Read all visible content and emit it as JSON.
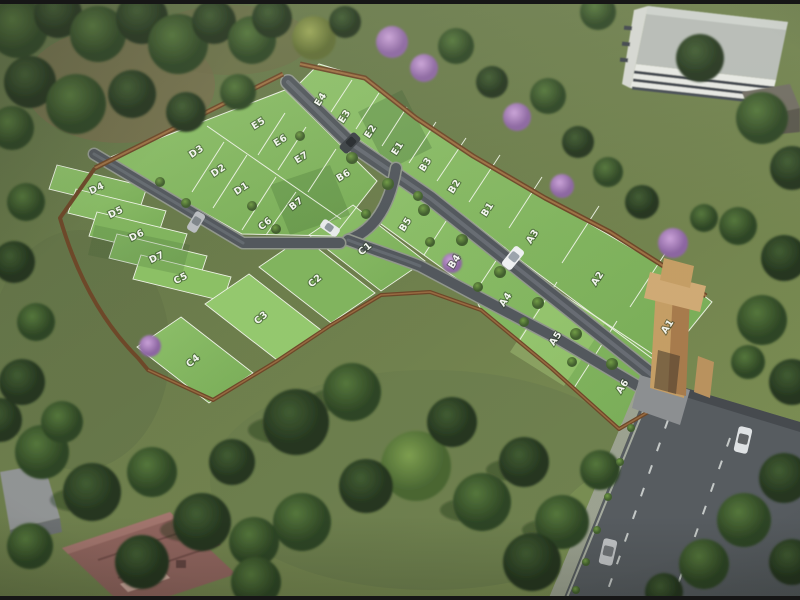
{
  "scene": {
    "title": "Aerial 3D render of a residential plotted layout",
    "setting": "Landscaped green site with white-lined grass plots, internal grey roads, brown boundary wall, sandstone entrance gate, surrounding trees and an adjacent public road"
  },
  "plots": {
    "count": 33,
    "series_names": [
      "A",
      "B",
      "C",
      "D",
      "E"
    ],
    "all": [
      "A1",
      "A2",
      "A3",
      "A4",
      "A5",
      "A6",
      "B1",
      "B2",
      "B3",
      "B4",
      "B5",
      "B6",
      "B7",
      "C1",
      "C2",
      "C3",
      "C4",
      "C5",
      "C6",
      "D1",
      "D2",
      "D3",
      "D4",
      "D5",
      "D6",
      "D7",
      "E1",
      "E2",
      "E3",
      "E4",
      "E5",
      "E6",
      "E7"
    ]
  },
  "objects": {
    "cars": [
      {
        "color": "dark grey SUV",
        "location": "top internal road"
      },
      {
        "color": "white sedan",
        "location": "central junction"
      },
      {
        "color": "white SUV",
        "location": "main internal road"
      },
      {
        "color": "silver SUV",
        "location": "west internal road"
      },
      {
        "color": "white SUV",
        "location": "public road (upper)"
      },
      {
        "color": "silver hatchback",
        "location": "public road (lower)"
      }
    ],
    "buildings": [
      {
        "type": "white multi-storey block with window bands",
        "location": "top right"
      },
      {
        "type": "grey-roof house",
        "location": "top right corner"
      },
      {
        "type": "brick-red apartment roof",
        "location": "bottom left"
      },
      {
        "type": "grey-roof building",
        "location": "far bottom left"
      }
    ],
    "entrance_gate": {
      "style": "sandstone tan arch pillar",
      "location": "right edge on public road"
    },
    "flowering_trees": "purple jacaranda accents along boundary"
  },
  "palette": {
    "plot_green": "#84b862",
    "field_green": "#6e7f4b",
    "road_grey": "#50555b",
    "wall_brown": "#7d5230",
    "gate_tan": "#c49c63",
    "tree_dark": "#2c4526",
    "jacaranda": "#b48ac8",
    "label_white": "#f5f7f2"
  }
}
